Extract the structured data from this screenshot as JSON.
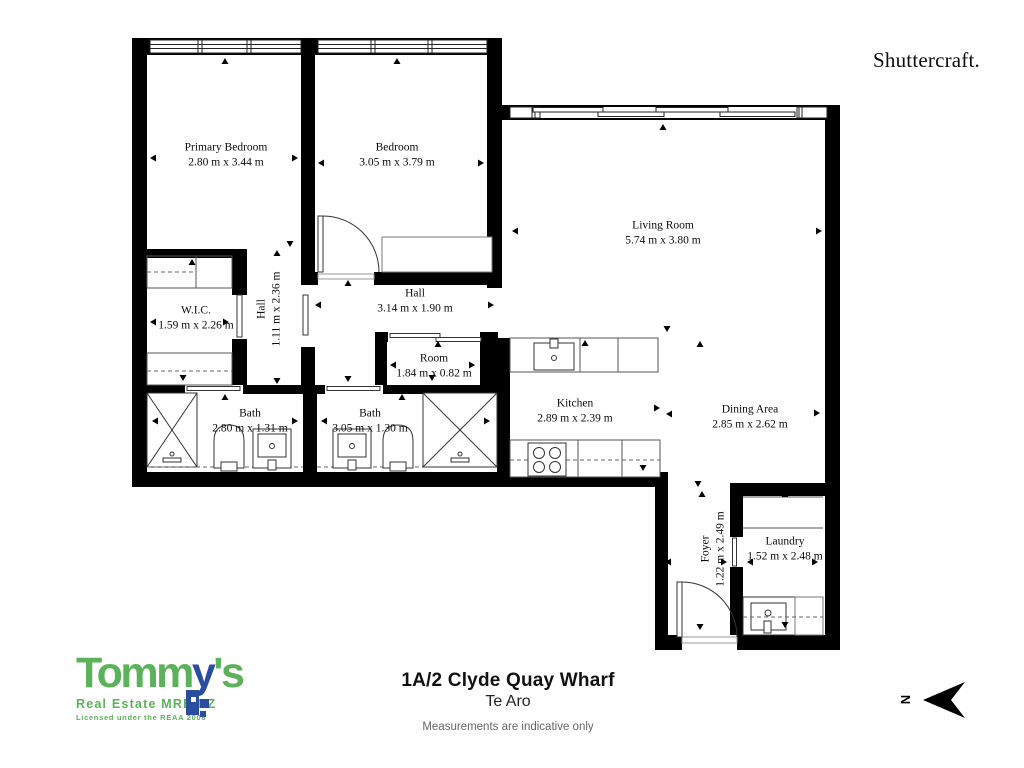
{
  "branding": {
    "shuttercraft": "Shuttercraft.",
    "tommys": {
      "name_green_1": "Tomm",
      "name_blue": "y",
      "name_green_2": "'s",
      "tagline": "Real Estate MREINZ",
      "license": "Licensed under the REAA 2008",
      "green": "#5cb25a",
      "blue": "#2a4da0"
    }
  },
  "title_block": {
    "address": "1A/2 Clyde Quay Wharf",
    "suburb": "Te Aro",
    "disclaimer": "Measurements are indicative only"
  },
  "compass": {
    "label": "N"
  },
  "rooms": [
    {
      "name": "Primary Bedroom",
      "dims": "2.80 m x 3.44 m"
    },
    {
      "name": "Bedroom",
      "dims": "3.05 m x 3.79 m"
    },
    {
      "name": "Living Room",
      "dims": "5.74 m x 3.80 m"
    },
    {
      "name": "W.I.C.",
      "dims": "1.59 m x 2.26 m"
    },
    {
      "name": "Hall",
      "dims": "1.11 m x 2.36 m"
    },
    {
      "name": "Hall",
      "dims": "3.14 m x 1.90 m"
    },
    {
      "name": "Room",
      "dims": "1.84 m x 0.82 m"
    },
    {
      "name": "Kitchen",
      "dims": "2.89 m x 2.39 m"
    },
    {
      "name": "Dining Area",
      "dims": "2.85 m x 2.62 m"
    },
    {
      "name": "Bath",
      "dims": "2.80 m x 1.31 m"
    },
    {
      "name": "Bath",
      "dims": "3.05 m x 1.30 m"
    },
    {
      "name": "Foyer",
      "dims": "1.22 m x 2.49 m"
    },
    {
      "name": "Laundry",
      "dims": "1.52 m x 2.48 m"
    }
  ]
}
